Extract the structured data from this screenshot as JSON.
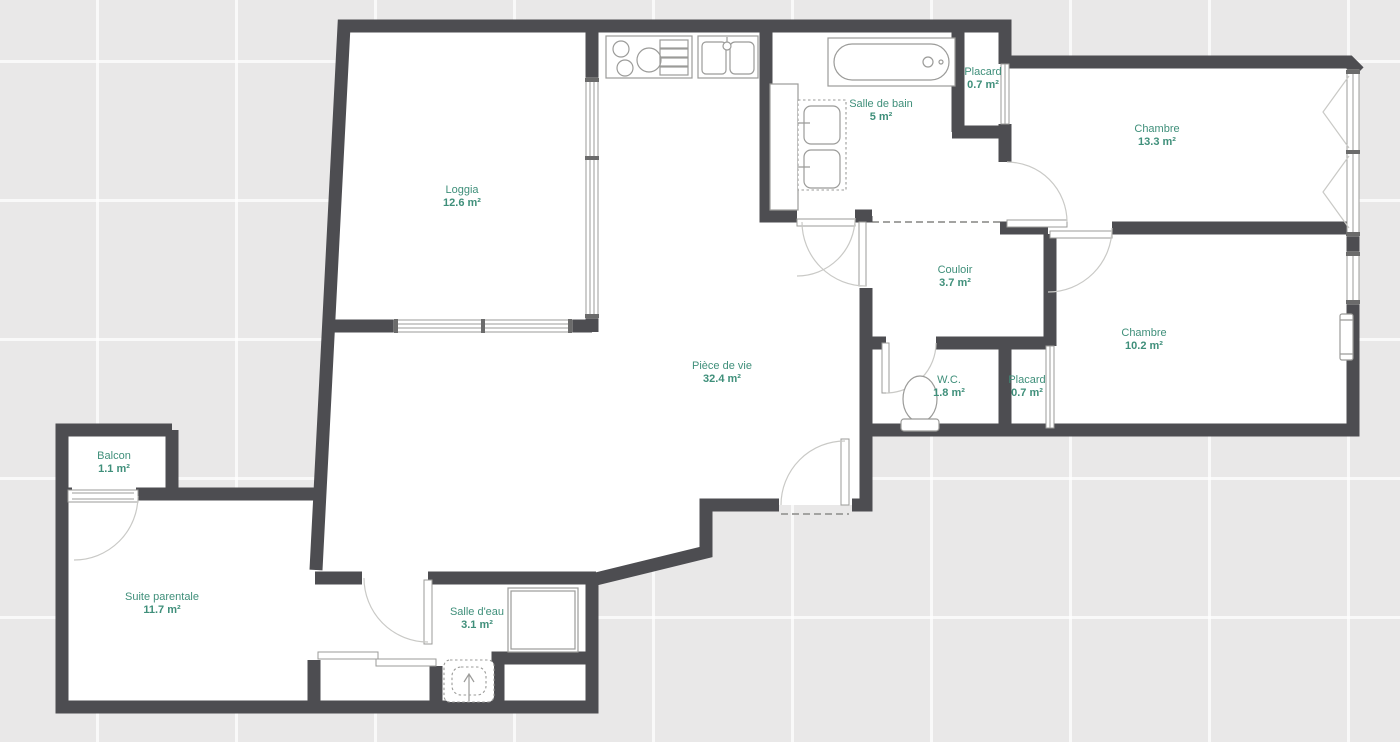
{
  "title": "Plan d'appartement",
  "colors": {
    "wall": "#4d4d51",
    "label": "#3f8f7a",
    "bg": "#e9e8e8",
    "grid": "#ffffffb8",
    "room": "#ffffff",
    "fixture": "#9b9b99",
    "arc": "#c9c9c6"
  },
  "rooms": [
    {
      "id": "loggia",
      "name": "Loggia",
      "area": "12.6 m²"
    },
    {
      "id": "salle-de-bain",
      "name": "Salle de bain",
      "area": "5 m²"
    },
    {
      "id": "placard-haut",
      "name": "Placard",
      "area": "0.7 m²"
    },
    {
      "id": "chambre-1",
      "name": "Chambre",
      "area": "13.3 m²"
    },
    {
      "id": "couloir",
      "name": "Couloir",
      "area": "3.7 m²"
    },
    {
      "id": "chambre-2",
      "name": "Chambre",
      "area": "10.2 m²"
    },
    {
      "id": "piece-de-vie",
      "name": "Pièce de vie",
      "area": "32.4 m²"
    },
    {
      "id": "wc",
      "name": "W.C.",
      "area": "1.8 m²"
    },
    {
      "id": "placard-bas",
      "name": "Placard",
      "area": "0.7 m²"
    },
    {
      "id": "balcon",
      "name": "Balcon",
      "area": "1.1 m²"
    },
    {
      "id": "suite-parentale",
      "name": "Suite parentale",
      "area": "11.7 m²"
    },
    {
      "id": "salle-deau",
      "name": "Salle d'eau",
      "area": "3.1 m²"
    }
  ],
  "fixtures": [
    "cooktop",
    "kitchen-sink",
    "bathtub",
    "double-washbasin",
    "tall-cabinet",
    "toilet",
    "shower",
    "washbasin",
    "radiator",
    "sliding-closet-doors",
    "hinged-doors",
    "windows"
  ]
}
